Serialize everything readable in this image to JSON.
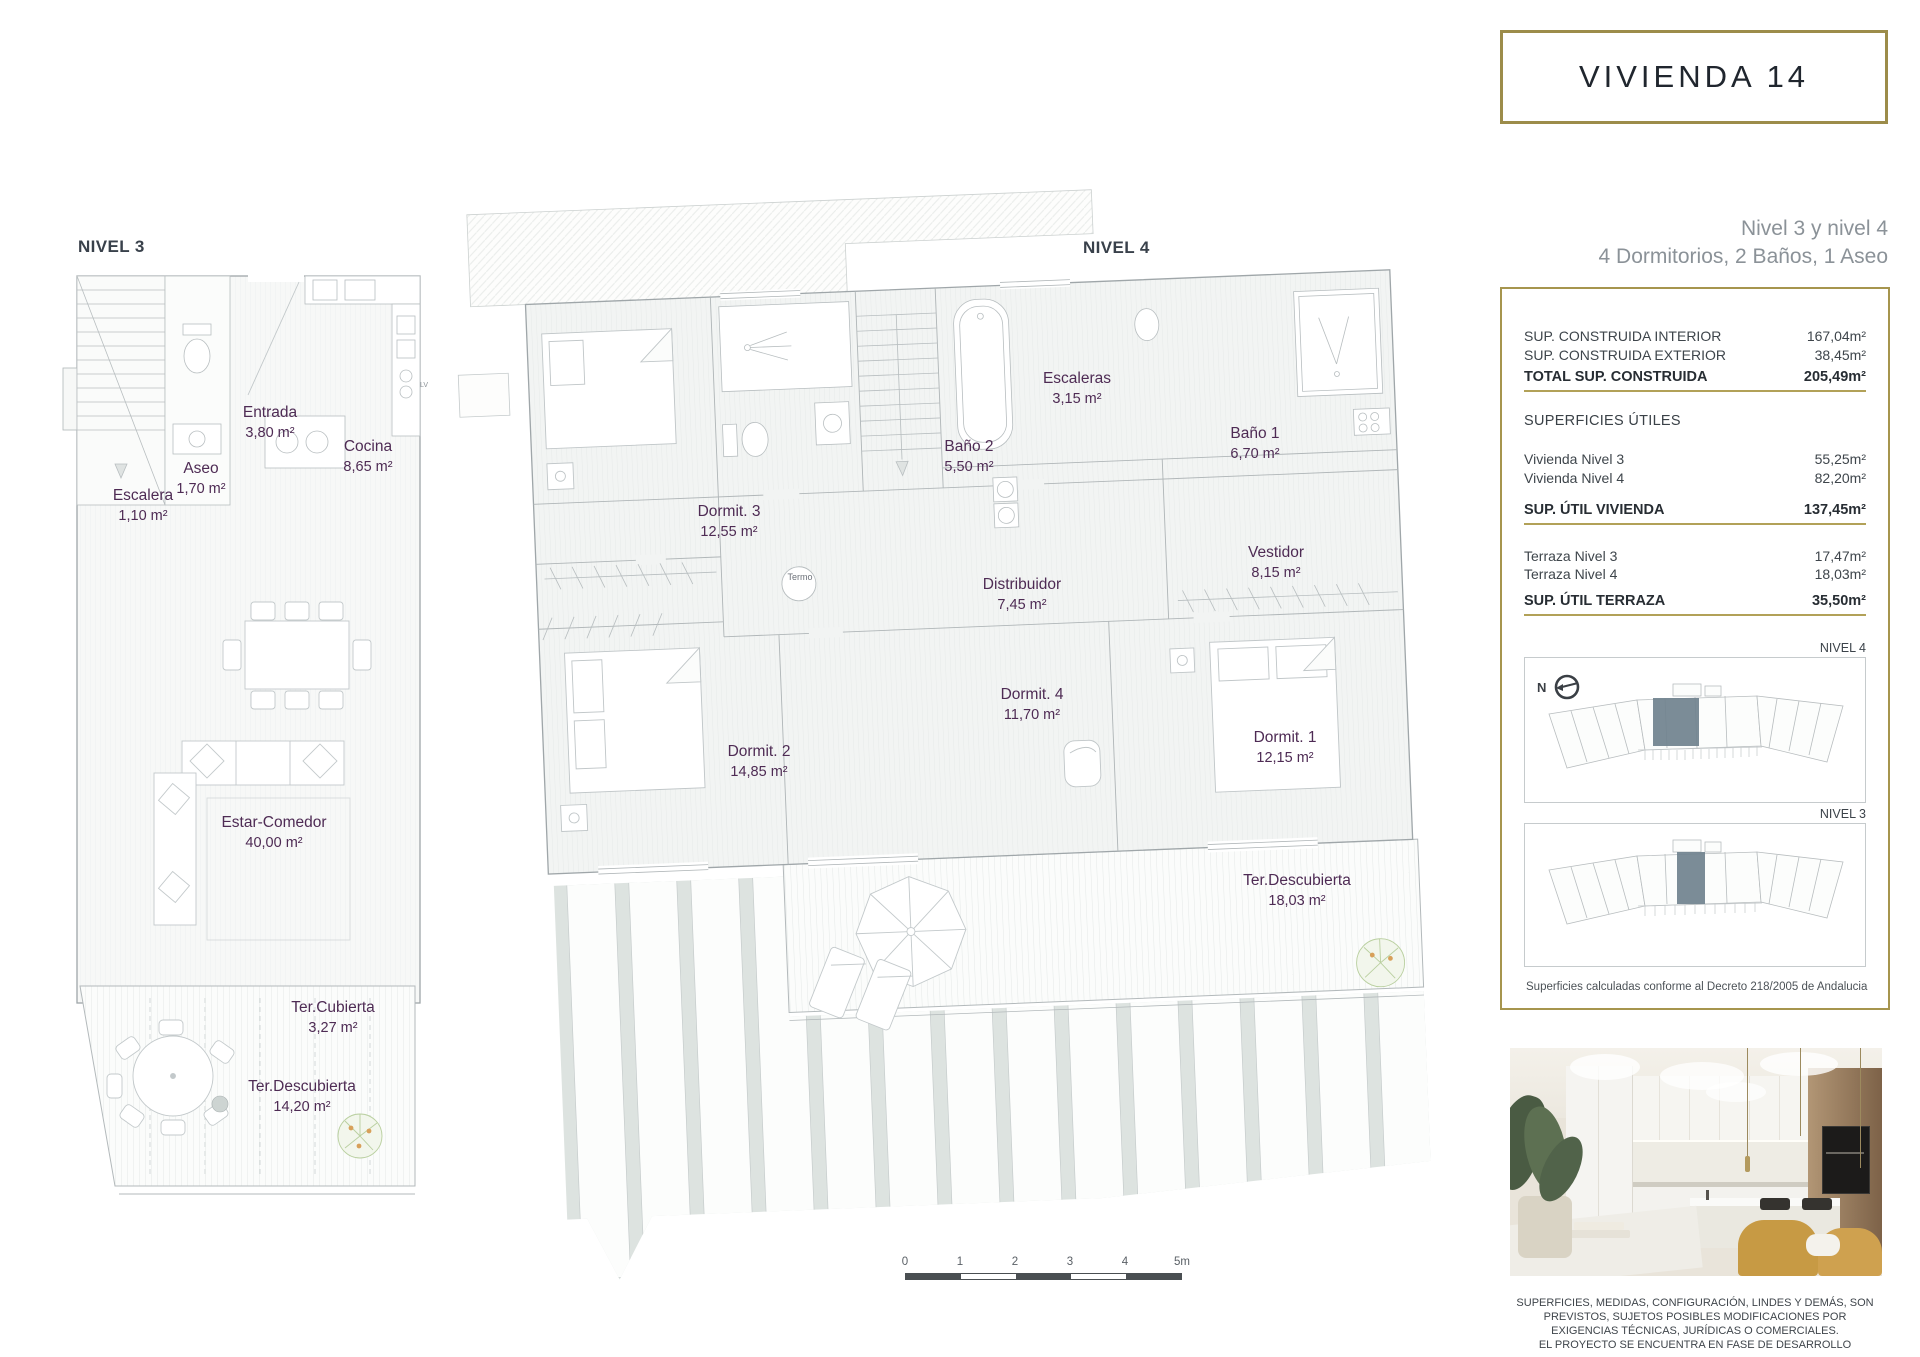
{
  "title": "VIVIENDA 14",
  "subtitle": {
    "line1": "Nivel 3 y nivel 4",
    "line2": "4 Dormitorios, 2 Baños, 1 Aseo"
  },
  "colors": {
    "gold": "#a6954e",
    "room_label": "#4e2b54",
    "keyplan_highlight": "#70828e"
  },
  "areas_panel": {
    "construida": [
      {
        "label": "SUP. CONSTRUIDA INTERIOR",
        "value": "167,04m²"
      },
      {
        "label": "SUP. CONSTRUIDA EXTERIOR",
        "value": "38,45m²"
      }
    ],
    "construida_total": {
      "label": "TOTAL SUP. CONSTRUIDA",
      "value": "205,49m²"
    },
    "utiles_header": "SUPERFICIES ÚTILES",
    "utiles": [
      {
        "label": "Vivienda Nivel 3",
        "value": "55,25m²"
      },
      {
        "label": "Vivienda Nivel 4",
        "value": "82,20m²"
      }
    ],
    "utiles_total": {
      "label": "SUP. ÚTIL VIVIENDA",
      "value": "137,45m²"
    },
    "terraza": [
      {
        "label": "Terraza Nivel 3",
        "value": "17,47m²"
      },
      {
        "label": "Terraza Nivel 4",
        "value": "18,03m²"
      }
    ],
    "terraza_total": {
      "label": "SUP. ÚTIL TERRAZA",
      "value": "35,50m²"
    },
    "compass": "N",
    "keyplans": [
      {
        "label": "NIVEL 4"
      },
      {
        "label": "NIVEL 3"
      }
    ],
    "note": "Superficies calculadas conforme al Decreto 218/2005 de Andalucia"
  },
  "plans": {
    "nivel3": {
      "label": "NIVEL 3",
      "lv_label": "LV",
      "rooms": [
        {
          "name": "Entrada",
          "area": "3,80 m²"
        },
        {
          "name": "Cocina",
          "area": "8,65 m²"
        },
        {
          "name": "Aseo",
          "area": "1,70 m²"
        },
        {
          "name": "Escalera",
          "area": "1,10 m²"
        },
        {
          "name": "Estar-Comedor",
          "area": "40,00 m²"
        },
        {
          "name": "Ter.Cubierta",
          "area": "3,27 m²"
        },
        {
          "name": "Ter.Descubierta",
          "area": "14,20 m²"
        }
      ]
    },
    "nivel4": {
      "label": "NIVEL 4",
      "rooms": [
        {
          "name": "Escaleras",
          "area": "3,15 m²"
        },
        {
          "name": "Baño 2",
          "area": "5,50 m²"
        },
        {
          "name": "Baño 1",
          "area": "6,70 m²"
        },
        {
          "name": "Dormit. 3",
          "area": "12,55 m²"
        },
        {
          "name": "Vestidor",
          "area": "8,15 m²"
        },
        {
          "name": "Distribuidor",
          "area": "7,45 m²"
        },
        {
          "name": "Dormit. 4",
          "area": "11,70 m²"
        },
        {
          "name": "Dormit. 2",
          "area": "14,85 m²"
        },
        {
          "name": "Dormit. 1",
          "area": "12,15 m²"
        },
        {
          "name": "Ter.Descubierta",
          "area": "18,03 m²"
        },
        {
          "name": "Termo",
          "area": ""
        }
      ]
    }
  },
  "scalebar": {
    "labels": [
      "0",
      "1",
      "2",
      "3",
      "4",
      "5m"
    ]
  },
  "disclaimer": {
    "lines": [
      "SUPERFICIES, MEDIDAS, CONFIGURACIÓN, LINDES Y DEMÁS, SON",
      "PREVISTOS, SUJETOS POSIBLES MODIFICACIONES POR",
      "EXIGENCIAS TÉCNICAS, JURÍDICAS O COMERCIALES.",
      "EL PROYECTO SE ENCUENTRA EN FASE DE DESARROLLO"
    ]
  }
}
